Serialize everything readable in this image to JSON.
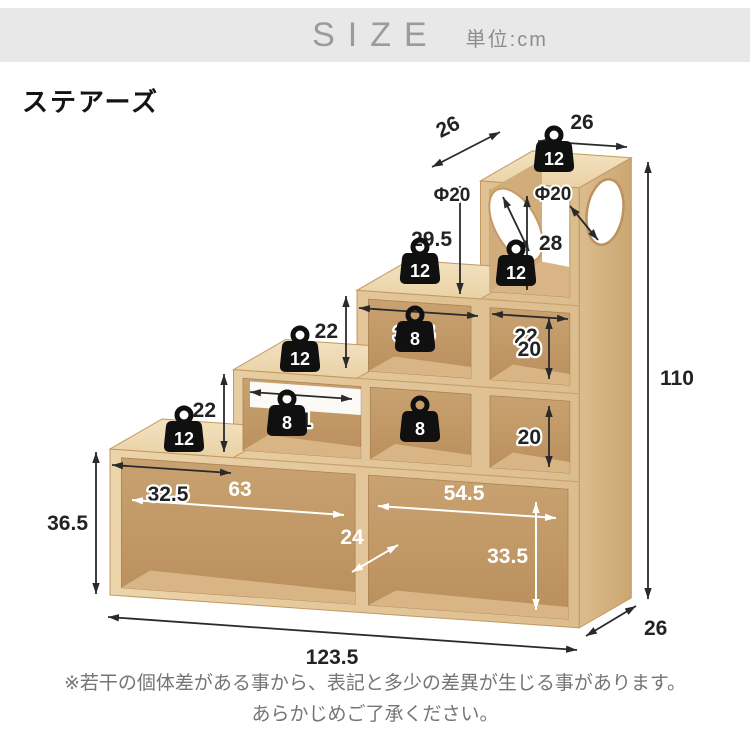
{
  "header": {
    "size_label": "SIZE",
    "unit_label": "単位:cm"
  },
  "title": "ステアーズ",
  "diagram": {
    "dimensions": {
      "column_depth": "26",
      "column_width": "26",
      "hole_left": "Φ20",
      "hole_right": "Φ20",
      "column_outer_height": "29.5",
      "column_inner_height": "28",
      "step3_width": "32.5",
      "column_base_width": "22",
      "rise_upper": "22",
      "rise_lower": "22",
      "shelf2_inner_width": "31",
      "step1_width": "32.5",
      "left_height": "36.5",
      "bottom_left_width": "63",
      "inner_depth": "24",
      "bottom_right_width": "54.5",
      "bottom_inner_height": "33.5",
      "upper_shelf_height": "20",
      "lower_shelf_height": "20",
      "total_width": "123.5",
      "total_height": "110",
      "base_depth": "26"
    },
    "load_capacities": {
      "column_top": "12",
      "step3_top": "12",
      "step2_top": "12",
      "step1_top": "12",
      "cube_inner": "12",
      "shelf3": "8",
      "shelf2_small": "8",
      "shelf2_right": "8"
    },
    "colors": {
      "wood_front": "#e7cda3",
      "wood_top": "#f1deba",
      "wood_side": "#d6b384",
      "wood_inner": "#c59e6d",
      "dimension_black": "#2a2a2a",
      "dimension_white": "#ffffff",
      "header_gray": "#e8e8e8"
    }
  },
  "note": {
    "line1": "※若干の個体差がある事から、表記と多少の差異が生じる事があります。",
    "line2": "あらかじめご了承ください。"
  }
}
